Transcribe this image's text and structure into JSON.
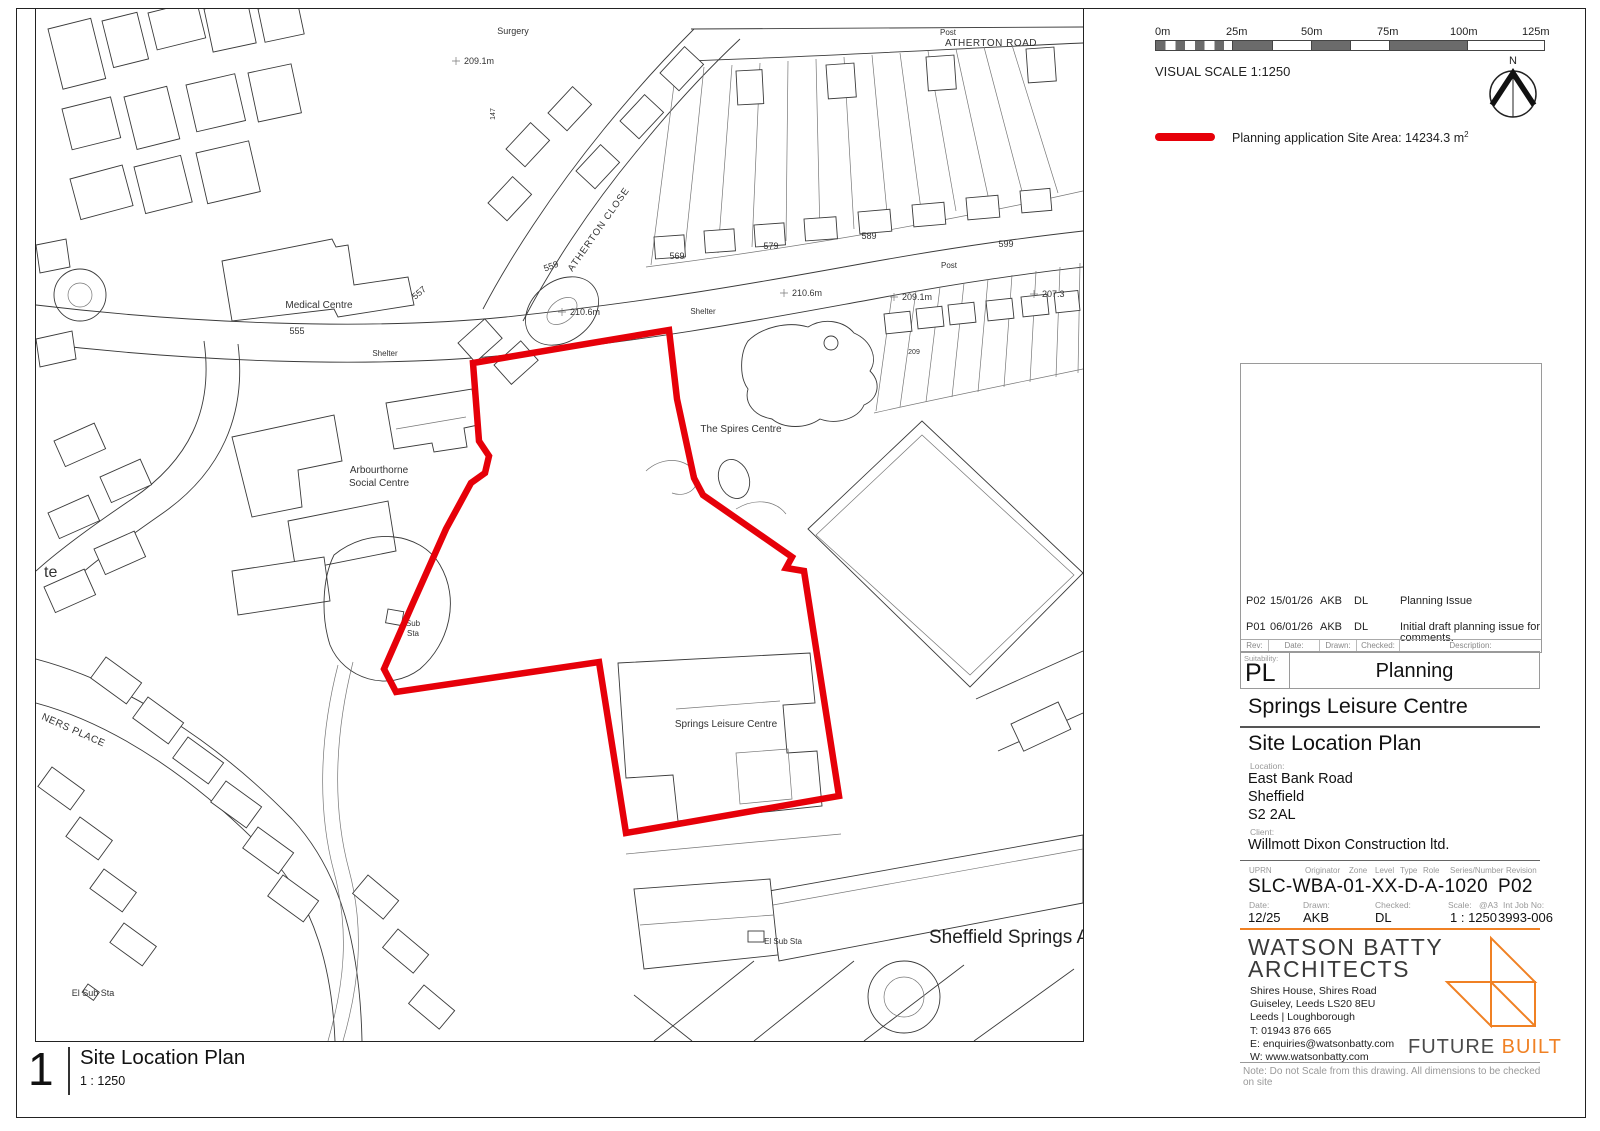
{
  "map": {
    "labels": {
      "surgery": "Surgery",
      "spot_a": "209.1m",
      "atherton_road": "ATHERTON ROAD",
      "atherton_close": "ATHERTON CLOSE",
      "post_top": "Post",
      "post_mid": "Post",
      "n555": "555",
      "n557": "557",
      "n559": "559",
      "n569": "569",
      "n579": "579",
      "n589": "589",
      "n599": "599",
      "n147": "147",
      "n209": "209",
      "spot_b": "210.6m",
      "spot_c": "210.6m",
      "spot_d": "209.1m",
      "spot_e": "207.3",
      "shelter_a": "Shelter",
      "shelter_b": "Shelter",
      "medical_centre": "Medical Centre",
      "arbourthorne_1": "Arbourthorne",
      "arbourthorne_2": "Social Centre",
      "spires": "The Spires Centre",
      "springs": "Springs Leisure Centre",
      "academy": "Sheffield Springs Aca",
      "el_sub_sta_a": "El Sub Sta",
      "el_sub_sta_b": "El Sub Sta",
      "sub_sta_1": "Sub",
      "sub_sta_2": "Sta",
      "miners": "NERS PLACE",
      "te": "te"
    }
  },
  "scalebar": {
    "ticks": [
      "0m",
      "25m",
      "50m",
      "75m",
      "100m",
      "125m"
    ],
    "caption": "VISUAL SCALE 1:1250"
  },
  "north": {
    "label": "N"
  },
  "legend": {
    "text": "Planning application Site Area: 14234.3 m",
    "sup": "2"
  },
  "rev": {
    "rows": [
      {
        "rev": "P02",
        "date": "15/01/26",
        "drawn": "AKB",
        "checked": "DL",
        "desc": "Planning Issue"
      },
      {
        "rev": "P01",
        "date": "06/01/26",
        "drawn": "AKB",
        "checked": "DL",
        "desc": "Initial draft planning issue for comments."
      }
    ],
    "headers": {
      "rev": "Rev:",
      "date": "Date:",
      "drawn": "Drawn:",
      "checked": "Checked:",
      "desc": "Description:"
    }
  },
  "suit": {
    "label": "Suitability:",
    "code": "PL",
    "status": "Planning"
  },
  "project": {
    "title": "Springs Leisure Centre"
  },
  "drawing": {
    "title": "Site Location Plan"
  },
  "loc": {
    "label": "Location:",
    "line1": "East Bank Road",
    "line2": "Sheffield",
    "line3": "S2 2AL"
  },
  "client": {
    "label": "Client:",
    "name": "Willmott Dixon Construction ltd."
  },
  "num": {
    "headers": {
      "uprn": "UPRN",
      "originator": "Originator",
      "zone": "Zone",
      "level": "Level",
      "type": "Type",
      "role": "Role",
      "series": "Series/Number",
      "revision": "Revision"
    },
    "value": "SLC-WBA-01-XX-D-A-1020",
    "revision": "P02"
  },
  "meta": {
    "headers": {
      "date": "Date:",
      "drawn": "Drawn:",
      "checked": "Checked:",
      "scale": "Scale:",
      "at": "@A3",
      "job": "Int Job No:"
    },
    "values": {
      "date": "12/25",
      "drawn": "AKB",
      "checked": "DL",
      "scale": "1 : 1250",
      "job": "3993-006"
    }
  },
  "firm": {
    "name1": "WATSON BATTY",
    "name2": "ARCHITECTS",
    "addr1": "Shires House, Shires Road",
    "addr2": "Guiseley, Leeds LS20 8EU",
    "addr3": "Leeds | Loughborough",
    "addr4": "T: 01943 876 665",
    "addr5": "E: enquiries@watsonbatty.com",
    "addr6": "W: www.watsonbatty.com"
  },
  "fb": {
    "word1": "FUTURE",
    "word2": "BUILT"
  },
  "note": {
    "text": "Note: Do not Scale from this drawing. All dimensions to be checked on site"
  },
  "footer": {
    "number": "1",
    "title": "Site Location Plan",
    "scale": "1 : 1250"
  },
  "colors": {
    "boundary": "#e60009",
    "accent": "#f08124"
  }
}
